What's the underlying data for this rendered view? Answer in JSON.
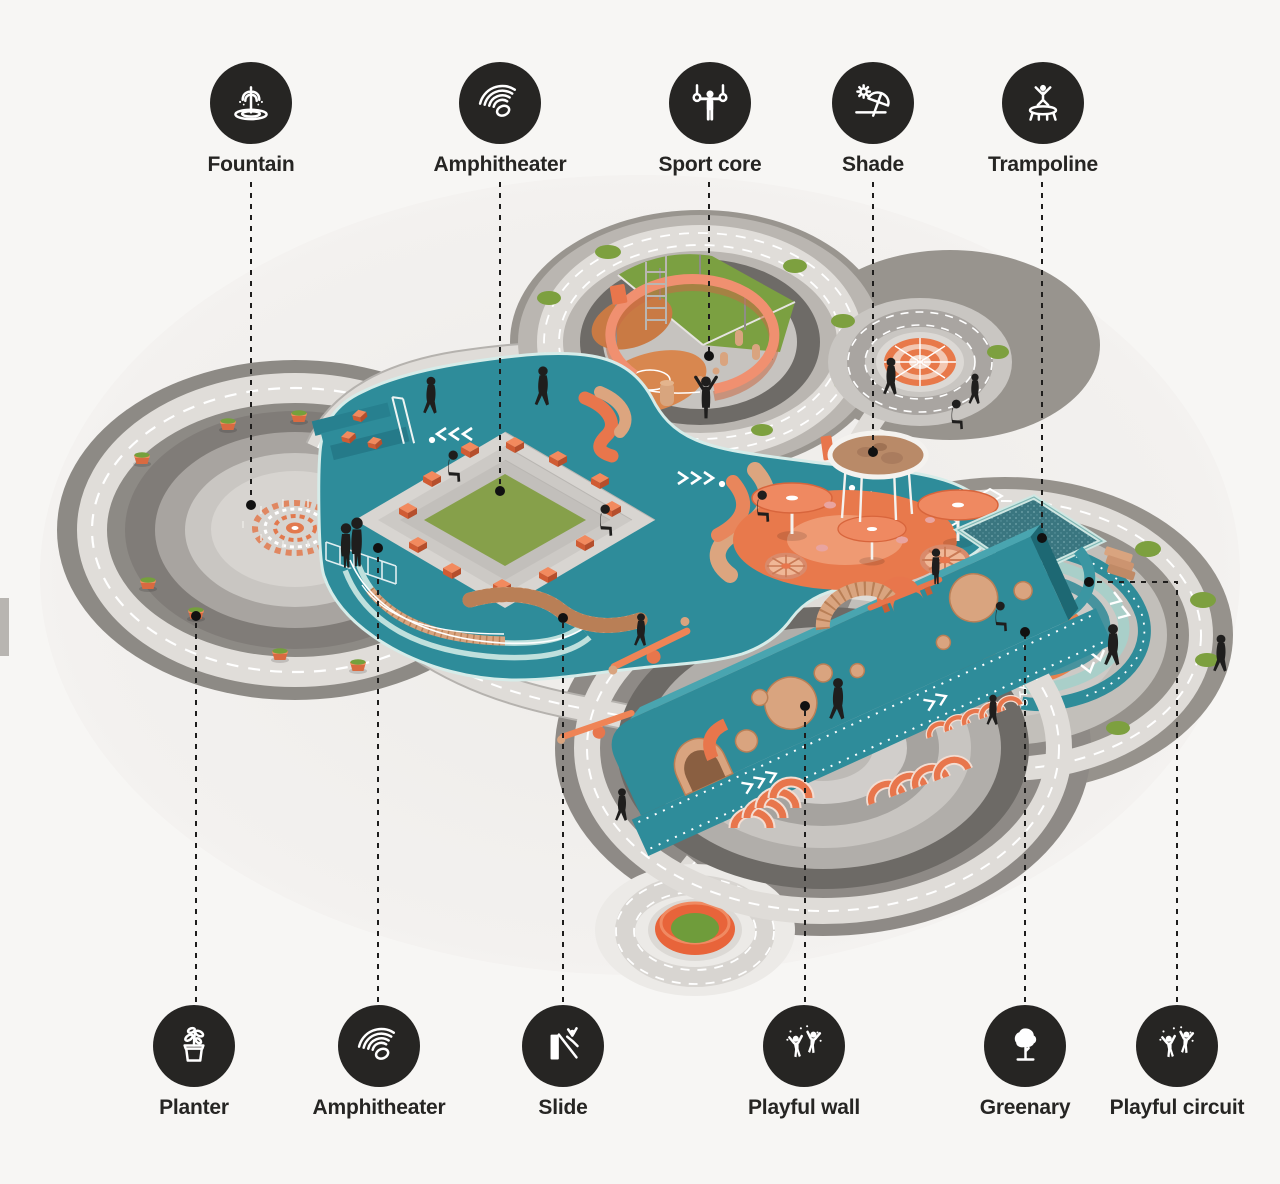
{
  "page": {
    "background": "#f7f6f4"
  },
  "legend_top": [
    {
      "id": "fountain",
      "label": "Fountain",
      "icon": "fountain-icon"
    },
    {
      "id": "amphitheater",
      "label": "Amphitheater",
      "icon": "amphitheater-icon"
    },
    {
      "id": "sport-core",
      "label": "Sport core",
      "icon": "sport-core-icon"
    },
    {
      "id": "shade",
      "label": "Shade",
      "icon": "shade-icon"
    },
    {
      "id": "trampoline",
      "label": "Trampoline",
      "icon": "trampoline-icon"
    }
  ],
  "legend_bottom": [
    {
      "id": "planter",
      "label": "Planter",
      "icon": "planter-icon"
    },
    {
      "id": "amphitheater-2",
      "label": "Amphitheater",
      "icon": "amphitheater-icon"
    },
    {
      "id": "slide",
      "label": "Slide",
      "icon": "slide-icon"
    },
    {
      "id": "playful-wall",
      "label": "Playful wall",
      "icon": "playful-wall-icon"
    },
    {
      "id": "greenary",
      "label": "Greenary",
      "icon": "greenary-icon"
    },
    {
      "id": "playful-circuit",
      "label": "Playful circuit",
      "icon": "playful-circuit-icon"
    }
  ],
  "illustration": {
    "type": "isometric-playground-masterplan",
    "texts": {
      "trampoline_mat": "JUMP",
      "circuit_start": "START"
    },
    "colors": {
      "teal": "#2e8c9a",
      "teal_light": "#cfe7e3",
      "orange": "#e8764c",
      "salmon": "#f09070",
      "wood": "#d9a47f",
      "lawn": "#85a148",
      "road": "#dfdcd8",
      "asphalt": "#8b8783",
      "dark_ring": "#6e6b67",
      "ink": "#1f1e1d"
    }
  }
}
